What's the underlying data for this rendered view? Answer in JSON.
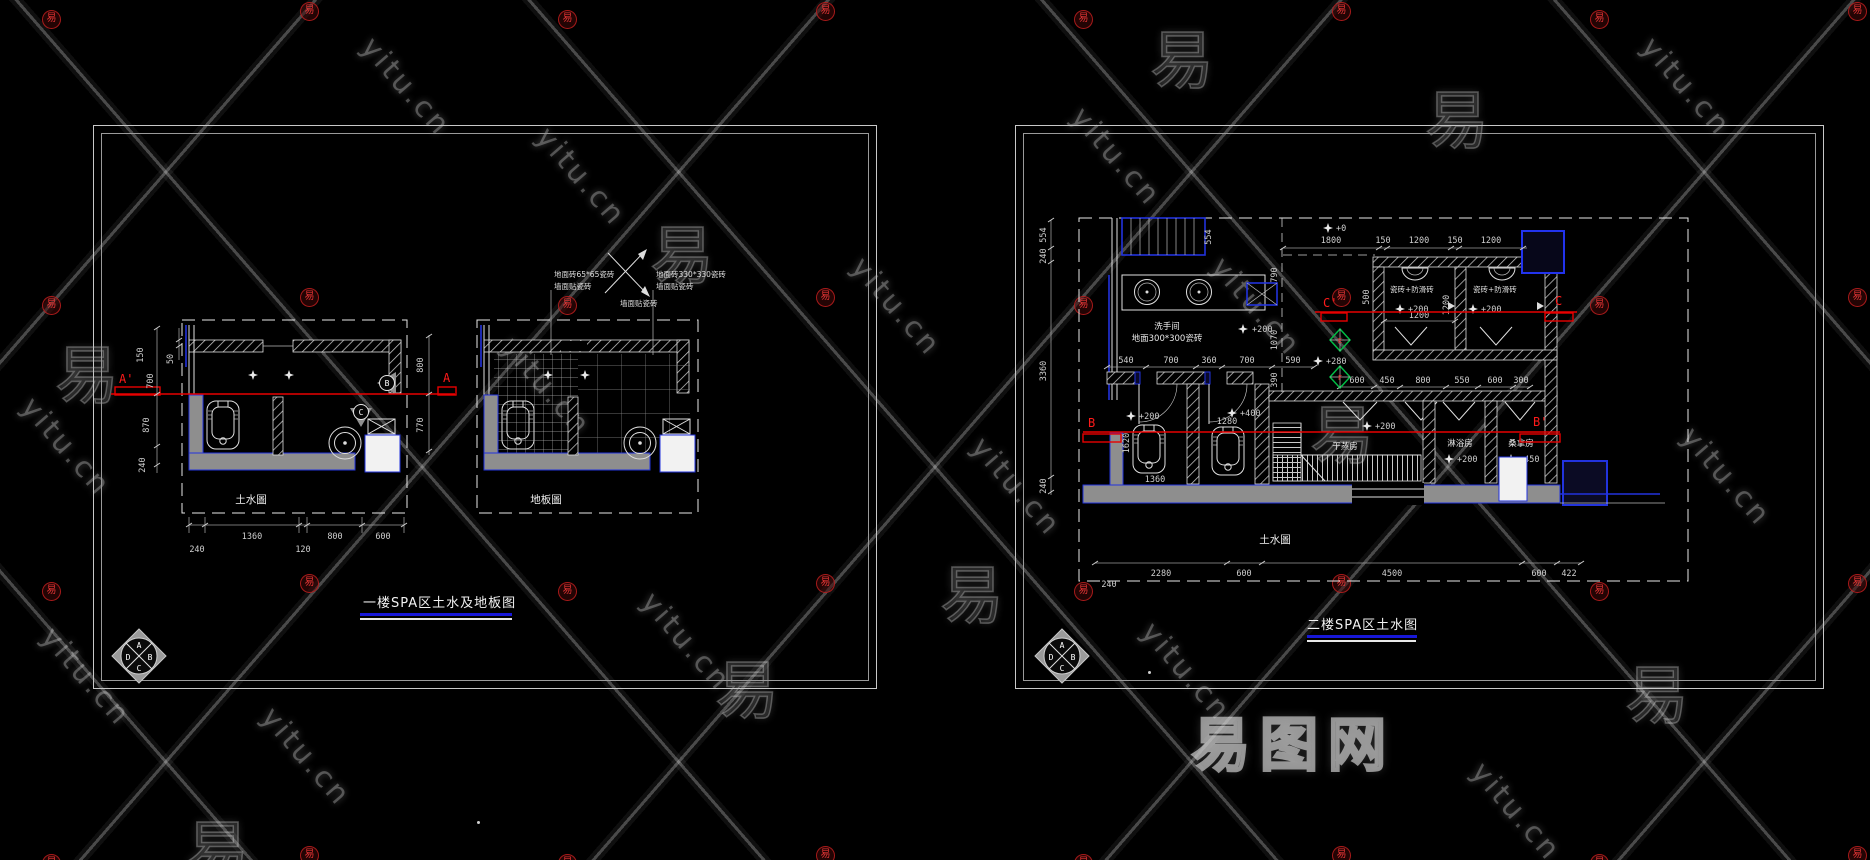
{
  "watermark": {
    "site": "yitu.cn",
    "char": "易",
    "badge": "易",
    "logo": "易图网"
  },
  "left_sheet": {
    "title": "一楼SPA区土水及地板图",
    "plan_left": {
      "label": "土水圖",
      "section_start": "A'",
      "section_end": "A",
      "marker_b": "B",
      "marker_c": "C",
      "dims_left": [
        "150",
        "50",
        "700",
        "870",
        "240"
      ],
      "dims_right": [
        "800",
        "770"
      ],
      "dims_bottom": [
        "1360",
        "800",
        "600"
      ],
      "dims_bottom2": [
        "240",
        "120"
      ]
    },
    "plan_right": {
      "label": "地板圖",
      "callout1_l1": "地面砖65*65瓷砖",
      "callout1_l2": "墙面贴瓷砖",
      "callout2_l1": "地面砖330*330瓷砖",
      "callout2_l2": "墙面贴瓷砖",
      "arrow_note": "墙面贴瓷砖"
    },
    "compass": {
      "top": "A",
      "right": "B",
      "bottom": "C",
      "left": "D"
    }
  },
  "right_sheet": {
    "title": "二楼SPA区土水图",
    "plan_label": "土水圖",
    "sections": {
      "c_start": "C'",
      "c_end": "C",
      "b_start": "B",
      "b_end": "B'"
    },
    "markers": {
      "e": "E",
      "f": "F"
    },
    "rooms": {
      "washroom": "洗手间",
      "washroom_note": "地面300*300瓷砖",
      "dry_steam": "干蒸房",
      "shower": "淋浴房",
      "sauna": "桑拿房",
      "toilet_note": "瓷砖+防滑砖"
    },
    "elev": {
      "zero": "+0",
      "e200": "+200",
      "e280": "+280",
      "e400": "+400",
      "e450": "+450"
    },
    "dims_top": [
      "1800",
      "150",
      "1200",
      "150",
      "1200"
    ],
    "dims_left": [
      "554",
      "240",
      "3360",
      "240"
    ],
    "dims_inner": [
      "554",
      "790",
      "1070",
      "390",
      "500"
    ],
    "dims_counter": [
      "540",
      "700",
      "360",
      "700",
      "590"
    ],
    "dims_mid": [
      "600",
      "450",
      "800",
      "550",
      "600",
      "300"
    ],
    "dims_toilet_w": "1200",
    "dims_toilet_h": "1200",
    "dims_tub": [
      "1620",
      "1360",
      "1280"
    ],
    "dims_bottom": [
      "2280",
      "600",
      "4500",
      "600",
      "422"
    ],
    "dim_offset": "240",
    "compass": {
      "top": "A",
      "right": "B",
      "bottom": "C",
      "left": "D"
    }
  }
}
